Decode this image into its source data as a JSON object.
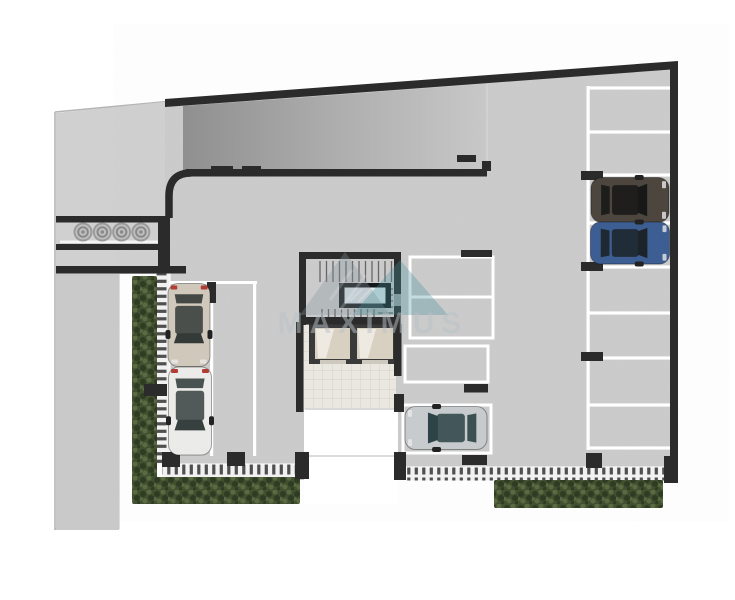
{
  "scene": {
    "label": "Top-down architectural render of a residential ground floor / parking level"
  },
  "watermark": {
    "text": "MAXIMUS"
  },
  "colors": {
    "background": "#ffffff",
    "floor": "#cbcbcb",
    "driveway": "#d0d0d0",
    "outside_floor": "#c9c9c9",
    "wall": "#2b2b2b",
    "ramp_dark": "#8e8e8e",
    "ramp_light": "#c8c8c8",
    "parking_line": "#ffffff",
    "fence_bg": "#f1f1f1",
    "fence_tick": "#4f4f4f",
    "hedge_base": "#41502f",
    "hedge_dark": "#2f3b22",
    "hedge_light": "#5a6a42",
    "lobby_tile": "#eae7e0",
    "tile_line": "#d5d1c6",
    "tread": "#666666",
    "skylight_frame": "#15181a",
    "skylight_glass": "#dde8ea",
    "elevator_shaft": "#3a3a3a",
    "elevator_car": "#d8d1c2",
    "elevator_hi": "#f2efe8",
    "bin_outer": "#9b9b9b",
    "bin_mid": "#c0c0c0",
    "bin_ring": "#8a8a8a",
    "curb": "#b4b4b4",
    "watermark_text": "#b9c2c9",
    "logo_gray": "#8694a0",
    "logo_teal": "#46929b"
  },
  "bins": {
    "count": 4
  },
  "parking": {
    "left_column": {
      "occupied": 2,
      "line_xs": [
        210,
        253
      ]
    },
    "middle_column": {
      "spaces": 4,
      "occupied": 1
    },
    "right_column": {
      "spaces": 8,
      "occupied": 2,
      "divider_ys": [
        88,
        132,
        175,
        223,
        267,
        313,
        358,
        405,
        448
      ]
    }
  },
  "cars": [
    {
      "name": "beige-hatchback",
      "cx": 189,
      "cy": 325,
      "width": 42,
      "length": 83,
      "angle": 0,
      "body": "#cfc8bb",
      "glass": "#333a38",
      "tail": "#b23b33"
    },
    {
      "name": "white-sedan",
      "cx": 190,
      "cy": 411,
      "width": 43,
      "length": 88,
      "angle": 0,
      "body": "#ebebe9",
      "glass": "#36413f",
      "tail": "#b23b33"
    },
    {
      "name": "dark-suv",
      "cx": 630,
      "cy": 200,
      "width": 45,
      "length": 78,
      "angle": -90,
      "body": "#4c463e",
      "glass": "#181818",
      "tail": null
    },
    {
      "name": "blue-sedan",
      "cx": 630,
      "cy": 243,
      "width": 42,
      "length": 79,
      "angle": -90,
      "body": "#3d5e92",
      "glass": "#1c2329",
      "tail": null
    },
    {
      "name": "silver-sedan",
      "cx": 446,
      "cy": 428,
      "width": 43,
      "length": 82,
      "angle": 90,
      "body": "#c7cbcd",
      "glass": "#2c4347",
      "tail": null
    }
  ]
}
